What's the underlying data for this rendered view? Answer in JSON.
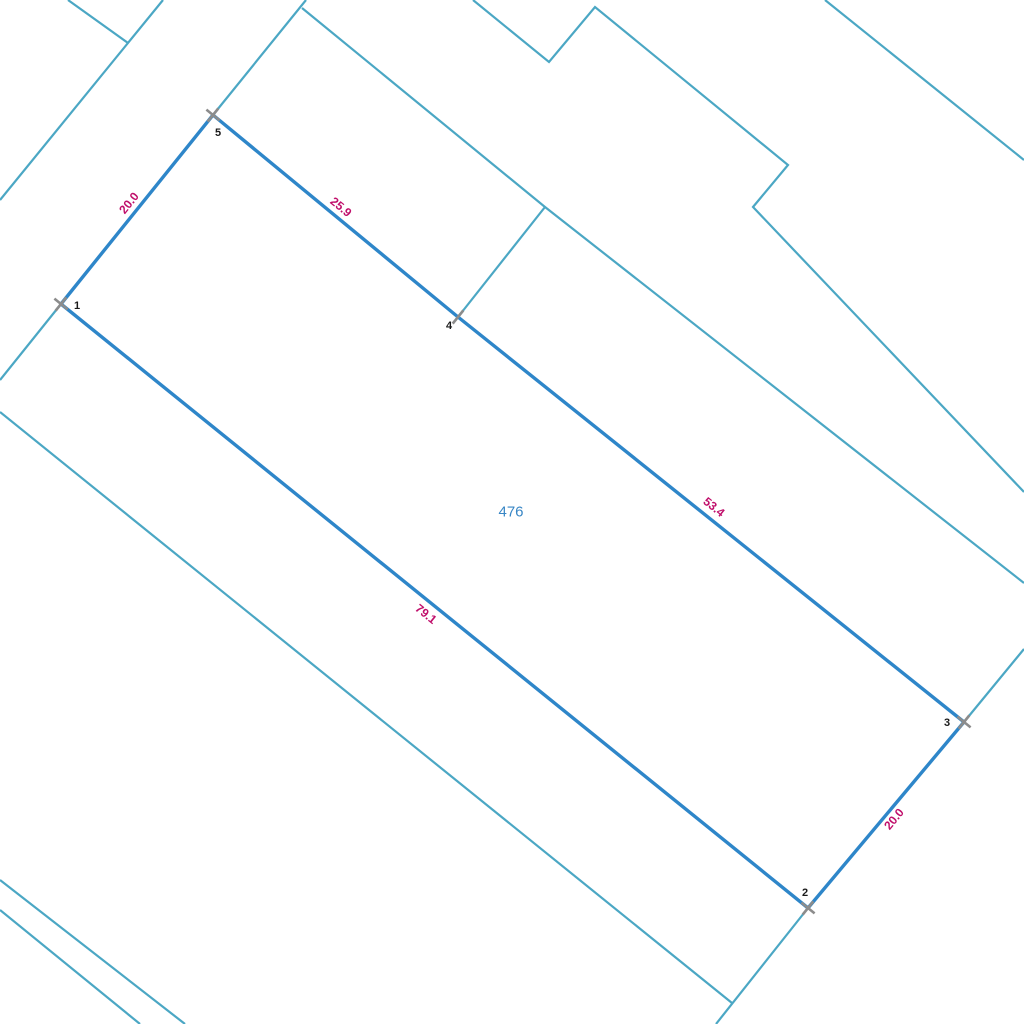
{
  "map": {
    "width": 1024,
    "height": 1024,
    "background": "#ffffff",
    "colors": {
      "neighbor_boundary_teal": "#4BA7C4",
      "selected_parcel_blue": "#2E86C9",
      "dimension_label_magenta": "#C00F6B",
      "vertex_tick_gray": "#8C8C8C",
      "vertex_number_black": "#1A1A1A",
      "parcel_number_blue": "#3886C5"
    },
    "parcel": {
      "number": "476",
      "number_pos": {
        "x": 511,
        "y": 512
      },
      "vertices": [
        {
          "id": "1",
          "x": 61,
          "y": 304,
          "label_x": 77,
          "label_y": 306,
          "tick": "x"
        },
        {
          "id": "5",
          "x": 213,
          "y": 115,
          "label_x": 218,
          "label_y": 133,
          "tick": "x"
        },
        {
          "id": "4",
          "x": 458,
          "y": 317,
          "label_x": 449,
          "label_y": 326,
          "tick": "cross"
        },
        {
          "id": "3",
          "x": 964,
          "y": 722,
          "label_x": 947,
          "label_y": 723,
          "tick": "x"
        },
        {
          "id": "2",
          "x": 808,
          "y": 908,
          "label_x": 805,
          "label_y": 893,
          "tick": "x"
        }
      ],
      "outline_order": [
        "1",
        "5",
        "4",
        "3",
        "2"
      ],
      "edges": [
        {
          "from": "1",
          "to": "5",
          "length": "20.0",
          "label_x": 129,
          "label_y": 203,
          "label_angle": -51.2
        },
        {
          "from": "5",
          "to": "4",
          "length": "25.9",
          "label_x": 341,
          "label_y": 207,
          "label_angle": 39.5
        },
        {
          "from": "4",
          "to": "3",
          "length": "53.4",
          "label_x": 714,
          "label_y": 507,
          "label_angle": 38.7
        },
        {
          "from": "3",
          "to": "2",
          "length": "20.0",
          "label_x": 894,
          "label_y": 819,
          "label_angle": -50.2
        },
        {
          "from": "2",
          "to": "1",
          "length": "79.1",
          "label_x": 426,
          "label_y": 614,
          "label_angle": 39.0
        }
      ]
    },
    "boundary_lines": [
      {
        "name": "top-left-stub",
        "points": [
          [
            68,
            0
          ],
          [
            128,
            43
          ]
        ]
      },
      {
        "name": "top-left-diagonal",
        "points": [
          [
            163,
            0
          ],
          [
            0,
            200
          ]
        ]
      },
      {
        "name": "vertex5-extension-north",
        "points": [
          [
            306,
            0
          ],
          [
            213,
            115
          ]
        ]
      },
      {
        "name": "vertex1-extension-south",
        "points": [
          [
            61,
            304
          ],
          [
            0,
            380
          ]
        ]
      },
      {
        "name": "mid-parallel-line",
        "points": [
          [
            302,
            8
          ],
          [
            545,
            207
          ],
          [
            1024,
            583
          ]
        ]
      },
      {
        "name": "vertex4-branch",
        "points": [
          [
            545,
            207
          ],
          [
            458,
            317
          ]
        ]
      },
      {
        "name": "north-zigzag",
        "points": [
          [
            473,
            0
          ],
          [
            549,
            62
          ],
          [
            595,
            7
          ],
          [
            788,
            165
          ],
          [
            753,
            207
          ],
          [
            1024,
            492
          ]
        ]
      },
      {
        "name": "top-right-diagonal",
        "points": [
          [
            825,
            0
          ],
          [
            1024,
            160
          ]
        ]
      },
      {
        "name": "vertex3-extension-east",
        "points": [
          [
            1024,
            649
          ],
          [
            964,
            722
          ]
        ]
      },
      {
        "name": "vertex2-extension-south",
        "points": [
          [
            808,
            908
          ],
          [
            716,
            1024
          ]
        ]
      },
      {
        "name": "southwest-parallel-line",
        "points": [
          [
            0,
            412
          ],
          [
            732,
            1003
          ]
        ]
      },
      {
        "name": "bottom-left-line-a",
        "points": [
          [
            0,
            880
          ],
          [
            185,
            1024
          ]
        ]
      },
      {
        "name": "bottom-left-line-b",
        "points": [
          [
            0,
            910
          ],
          [
            140,
            1024
          ]
        ]
      }
    ],
    "style": {
      "neighbor_stroke_width": 2.2,
      "parcel_stroke_width": 3.4,
      "tick_stroke_width": 2.6,
      "tick_half_length": 8.5,
      "dimension_font_size": 12,
      "vertex_font_size": 11,
      "parcel_number_font_size": 15
    }
  }
}
